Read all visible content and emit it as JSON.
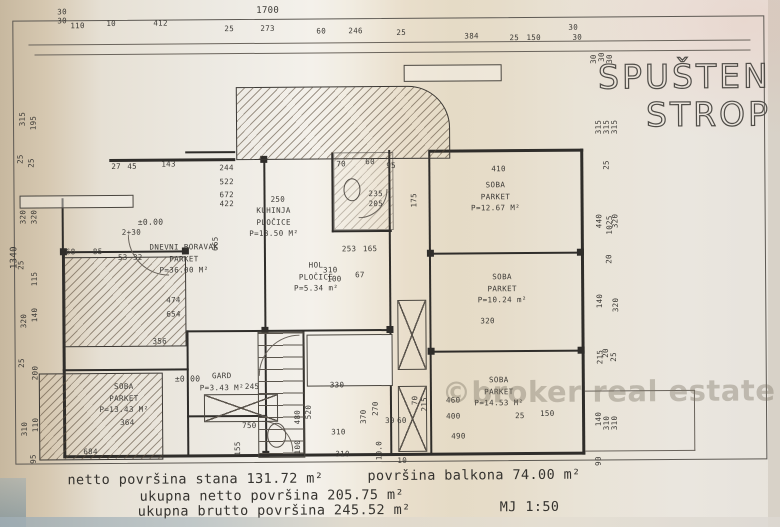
{
  "title": {
    "line1": "SPUŠTEN",
    "line2": "STROP"
  },
  "watermark": "©broker real estate",
  "scale": "MJ 1:50",
  "summary": {
    "netto_stana": "netto površina stana  131.72 m²",
    "balkon": "površina balkona  74.00 m²",
    "ukupna_netto": "ukupna netto površina  205.75 m²",
    "ukupna_brutto": "ukupna brutto površina  245.52 m²"
  },
  "rooms": [
    {
      "l1": "DNEVNI BORAVAK",
      "l2": "PARKET",
      "l3": "P=36.00 M²",
      "x": 140,
      "y": 240,
      "w": 88
    },
    {
      "l1": "KUHINJA",
      "l2": "PLOČICE",
      "l3": "P=13.50 M²",
      "x": 242,
      "y": 204,
      "w": 64
    },
    {
      "l1": "HOL",
      "l2": "PLOČICE",
      "l3": "P=5.34 m²",
      "x": 288,
      "y": 259,
      "w": 56
    },
    {
      "l1": "GARD",
      "l2": "P=3.43 M²",
      "x": 196,
      "y": 369,
      "w": 50
    },
    {
      "l1": "SOBA",
      "l2": "PARKET",
      "l3": "P=12.67 M²",
      "x": 462,
      "y": 180,
      "w": 68
    },
    {
      "l1": "SOBA",
      "l2": "PARKET",
      "l3": "P=10.24 m²",
      "x": 468,
      "y": 272,
      "w": 68
    },
    {
      "l1": "SOBA",
      "l2": "PARKET",
      "l3": "P=14.53 M²",
      "x": 464,
      "y": 375,
      "w": 68
    },
    {
      "l1": "SOBA",
      "l2": "PARKET",
      "l3": "P=13.43 M²",
      "x": 92,
      "y": 379,
      "w": 62
    }
  ],
  "dims": [
    {
      "t": "30",
      "x": 59,
      "y": 5
    },
    {
      "t": "30",
      "x": 59,
      "y": 14
    },
    {
      "t": "110",
      "x": 72,
      "y": 19
    },
    {
      "t": "10",
      "x": 108,
      "y": 17
    },
    {
      "t": "412",
      "x": 155,
      "y": 17
    },
    {
      "t": "1700",
      "x": 258,
      "y": 5,
      "fs": 9
    },
    {
      "t": "25",
      "x": 226,
      "y": 23
    },
    {
      "t": "273",
      "x": 262,
      "y": 23
    },
    {
      "t": "60",
      "x": 318,
      "y": 26
    },
    {
      "t": "246",
      "x": 350,
      "y": 26
    },
    {
      "t": "25",
      "x": 398,
      "y": 28
    },
    {
      "t": "384",
      "x": 466,
      "y": 32
    },
    {
      "t": "25",
      "x": 511,
      "y": 34
    },
    {
      "t": "150",
      "x": 528,
      "y": 34
    },
    {
      "t": "30",
      "x": 570,
      "y": 24
    },
    {
      "t": "30",
      "x": 574,
      "y": 34
    },
    {
      "t": "315",
      "x": 16,
      "y": 112,
      "r": 1
    },
    {
      "t": "195",
      "x": 27,
      "y": 116,
      "r": 1
    },
    {
      "t": "25",
      "x": 16,
      "y": 152,
      "r": 1
    },
    {
      "t": "25",
      "x": 27,
      "y": 156,
      "r": 1
    },
    {
      "t": "320",
      "x": 16,
      "y": 210,
      "r": 1
    },
    {
      "t": "320",
      "x": 27,
      "y": 210,
      "r": 1
    },
    {
      "t": "25",
      "x": 16,
      "y": 258,
      "r": 1
    },
    {
      "t": "115",
      "x": 27,
      "y": 272,
      "r": 1
    },
    {
      "t": "320",
      "x": 16,
      "y": 314,
      "r": 1
    },
    {
      "t": "140",
      "x": 27,
      "y": 308,
      "r": 1
    },
    {
      "t": "25",
      "x": 16,
      "y": 356,
      "r": 1
    },
    {
      "t": "200",
      "x": 27,
      "y": 366,
      "r": 1
    },
    {
      "t": "310",
      "x": 16,
      "y": 422,
      "r": 1
    },
    {
      "t": "110",
      "x": 27,
      "y": 418,
      "r": 1
    },
    {
      "t": "95",
      "x": 27,
      "y": 452,
      "r": 1
    },
    {
      "t": "1340",
      "x": 3,
      "y": 250,
      "r": 1,
      "fs": 9
    },
    {
      "t": "30",
      "x": 590,
      "y": 56,
      "r": 1
    },
    {
      "t": "30",
      "x": 598,
      "y": 54,
      "r": 1
    },
    {
      "t": "30",
      "x": 606,
      "y": 56,
      "r": 1
    },
    {
      "t": "315",
      "x": 592,
      "y": 124,
      "r": 1
    },
    {
      "t": "315",
      "x": 600,
      "y": 124,
      "r": 1
    },
    {
      "t": "315",
      "x": 608,
      "y": 124,
      "r": 1
    },
    {
      "t": "25",
      "x": 602,
      "y": 162,
      "r": 1
    },
    {
      "t": "440",
      "x": 592,
      "y": 218,
      "r": 1
    },
    {
      "t": "1025",
      "x": 600,
      "y": 222,
      "r": 1
    },
    {
      "t": "320",
      "x": 608,
      "y": 218,
      "r": 1
    },
    {
      "t": "20",
      "x": 604,
      "y": 256,
      "r": 1
    },
    {
      "t": "140",
      "x": 592,
      "y": 298,
      "r": 1
    },
    {
      "t": "320",
      "x": 608,
      "y": 302,
      "r": 1
    },
    {
      "t": "215",
      "x": 592,
      "y": 354,
      "r": 1
    },
    {
      "t": "20",
      "x": 600,
      "y": 350,
      "r": 1
    },
    {
      "t": "25",
      "x": 608,
      "y": 354,
      "r": 1
    },
    {
      "t": "140",
      "x": 590,
      "y": 416,
      "r": 1
    },
    {
      "t": "310",
      "x": 598,
      "y": 420,
      "r": 1
    },
    {
      "t": "310",
      "x": 606,
      "y": 420,
      "r": 1
    },
    {
      "t": "90",
      "x": 592,
      "y": 458,
      "r": 1
    },
    {
      "t": "27",
      "x": 112,
      "y": 160
    },
    {
      "t": "45",
      "x": 128,
      "y": 160
    },
    {
      "t": "143",
      "x": 162,
      "y": 158
    },
    {
      "t": "244",
      "x": 220,
      "y": 162
    },
    {
      "t": "522",
      "x": 220,
      "y": 176
    },
    {
      "t": "672",
      "x": 220,
      "y": 189
    },
    {
      "t": "422",
      "x": 220,
      "y": 198
    },
    {
      "t": "250",
      "x": 271,
      "y": 194
    },
    {
      "t": "235",
      "x": 369,
      "y": 189
    },
    {
      "t": "205",
      "x": 369,
      "y": 199
    },
    {
      "t": "95",
      "x": 387,
      "y": 161
    },
    {
      "t": "60",
      "x": 366,
      "y": 157
    },
    {
      "t": "70",
      "x": 337,
      "y": 159
    },
    {
      "t": "175",
      "x": 407,
      "y": 196,
      "r": 1
    },
    {
      "t": "±0.00",
      "x": 138,
      "y": 216,
      "fs": 8
    },
    {
      "t": "2+30",
      "x": 122,
      "y": 226
    },
    {
      "t": "68",
      "x": 66,
      "y": 245
    },
    {
      "t": "85",
      "x": 93,
      "y": 245
    },
    {
      "t": "53",
      "x": 118,
      "y": 251
    },
    {
      "t": "32",
      "x": 133,
      "y": 251
    },
    {
      "t": "665",
      "x": 208,
      "y": 238,
      "r": 1
    },
    {
      "t": "474",
      "x": 166,
      "y": 294
    },
    {
      "t": "654",
      "x": 166,
      "y": 308
    },
    {
      "t": "356",
      "x": 152,
      "y": 335
    },
    {
      "t": "310",
      "x": 323,
      "y": 265
    },
    {
      "t": "100",
      "x": 327,
      "y": 274
    },
    {
      "t": "67",
      "x": 355,
      "y": 270
    },
    {
      "t": "253",
      "x": 342,
      "y": 244
    },
    {
      "t": "165",
      "x": 363,
      "y": 244
    },
    {
      "t": "410",
      "x": 492,
      "y": 165
    },
    {
      "t": "320",
      "x": 480,
      "y": 317
    },
    {
      "t": "±0.00",
      "x": 174,
      "y": 373,
      "fs": 8
    },
    {
      "t": "245",
      "x": 244,
      "y": 381
    },
    {
      "t": "750",
      "x": 241,
      "y": 420
    },
    {
      "t": "155",
      "x": 229,
      "y": 443,
      "r": 1
    },
    {
      "t": "364",
      "x": 119,
      "y": 416
    },
    {
      "t": "684",
      "x": 82,
      "y": 445
    },
    {
      "t": "330",
      "x": 329,
      "y": 380
    },
    {
      "t": "310",
      "x": 330,
      "y": 427
    },
    {
      "t": "310",
      "x": 334,
      "y": 449
    },
    {
      "t": "520",
      "x": 300,
      "y": 407,
      "r": 1
    },
    {
      "t": "480",
      "x": 289,
      "y": 412,
      "r": 1
    },
    {
      "t": "370",
      "x": 355,
      "y": 412,
      "r": 1
    },
    {
      "t": "270",
      "x": 367,
      "y": 404,
      "r": 1
    },
    {
      "t": "100",
      "x": 289,
      "y": 442,
      "r": 1
    },
    {
      "t": "10.0",
      "x": 368,
      "y": 446,
      "r": 1
    },
    {
      "t": "30",
      "x": 384,
      "y": 416
    },
    {
      "t": "60",
      "x": 396,
      "y": 416
    },
    {
      "t": "10",
      "x": 396,
      "y": 456
    },
    {
      "t": "70",
      "x": 409,
      "y": 396,
      "r": 1
    },
    {
      "t": "215",
      "x": 416,
      "y": 400,
      "r": 1
    },
    {
      "t": "460",
      "x": 445,
      "y": 396
    },
    {
      "t": "400",
      "x": 445,
      "y": 412
    },
    {
      "t": "490",
      "x": 450,
      "y": 432
    },
    {
      "t": "150",
      "x": 539,
      "y": 410
    },
    {
      "t": "25",
      "x": 514,
      "y": 412
    }
  ]
}
